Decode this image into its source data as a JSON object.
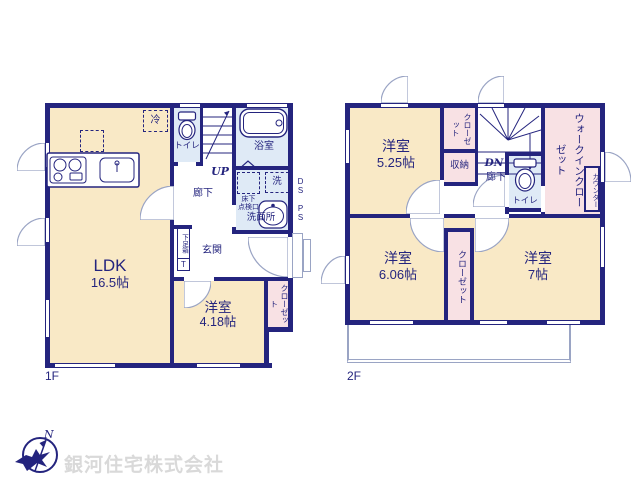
{
  "floor1": {
    "label": "1F",
    "ldk": {
      "name": "LDK",
      "size": "16.5帖"
    },
    "bedroom": {
      "name": "洋室",
      "size": "4.18帖"
    },
    "toilet": "トイレ",
    "bath": "浴室",
    "washroom": "洗面所",
    "hallway": "廊下",
    "entrance": "玄関",
    "closet": "クローゼット",
    "shoe_box": "下足箱",
    "shoe_box_t": "T",
    "fridge": "冷",
    "washer": "洗",
    "hatch_l1": "床下",
    "hatch_l2": "点検口",
    "up": "UP",
    "ds": "DS",
    "ps": "PS"
  },
  "floor2": {
    "label": "2F",
    "bedroom1": {
      "name": "洋室",
      "size": "5.25帖"
    },
    "bedroom2": {
      "name": "洋室",
      "size": "6.06帖"
    },
    "bedroom3": {
      "name": "洋室",
      "size": "7帖"
    },
    "closet_a": "クローゼット",
    "closet_b": "クローゼット",
    "storage": "収納",
    "walk_in_closet": "ウォークインクローゼット",
    "counter": "カウンター",
    "toilet": "トイレ",
    "hallway": "廊下",
    "dn": "DN"
  },
  "footer": {
    "company": "銀河住宅株式会社",
    "compass_n": "N"
  },
  "colors": {
    "wall": "#24247e",
    "room": "#f9e9c6",
    "wet_area": "#dfeaf6",
    "closet": "#f8e1e4",
    "line": "#9aa4c4",
    "footer_text": "#d9d9d9"
  }
}
